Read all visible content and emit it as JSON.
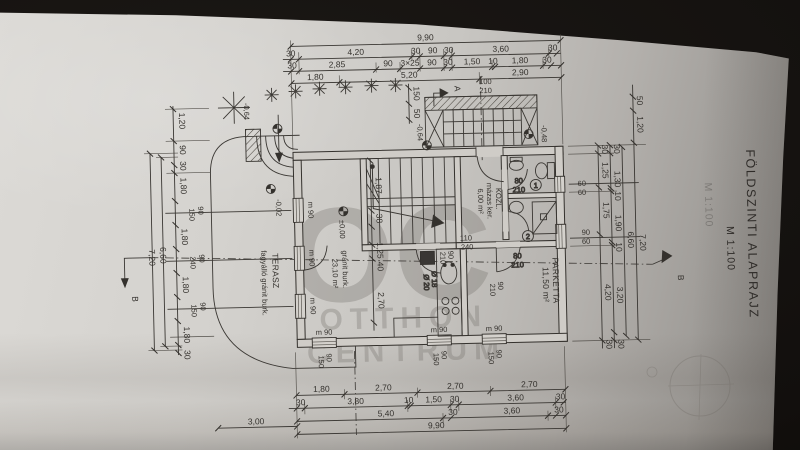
{
  "title_block": {
    "title": "FÖLDSZINTI ALAPRAJZ",
    "scale": "M 1:100",
    "ghost_scale": "M 1:100"
  },
  "watermark": {
    "big": "OC",
    "line2": "OTTHON",
    "line3": "CENTRUM"
  },
  "rooms": {
    "terasz": {
      "name": "TERASZ",
      "finish": "fagyálló gránit burk."
    },
    "living": {
      "finish": "gránit burk.",
      "area": "23,10 m²"
    },
    "kozl": {
      "name": "KÖZL.",
      "finish": "mázas ker.",
      "area": "6,00 m²"
    },
    "parketta": {
      "name": "PARKETTA",
      "area": "11,50 m²"
    }
  },
  "levels": {
    "terrace_steps": "-0,64",
    "terrace": "-0,02",
    "interior": "±0,00",
    "entry_left": "-0,64",
    "entry_right": "-0,48"
  },
  "sections": {
    "a": "A",
    "b": "B"
  },
  "doors": {
    "entrance": [
      "100",
      "210"
    ],
    "opening": [
      "110",
      "240"
    ],
    "kitchen": [
      "90",
      "210"
    ],
    "parketta": [
      "90",
      "210"
    ],
    "bath1": [
      "80",
      "210"
    ],
    "bath2": [
      "80",
      "210"
    ],
    "num1": "1",
    "num2": "2"
  },
  "chimney": [
    "Ø 18",
    "Ø 20"
  ],
  "windows": {
    "left": [
      {
        "m": "m 90",
        "w": "90",
        "h": "150"
      },
      {
        "m": "m 90",
        "w": "90",
        "h": "240"
      },
      {
        "m": "m 90",
        "w": "90",
        "h": "150"
      }
    ],
    "bottom": [
      {
        "m": "m 90",
        "w": "90",
        "h": "150"
      },
      {
        "m": "m 90",
        "w": "90",
        "h": "150"
      },
      {
        "m": "m 90",
        "w": "90",
        "h": "150"
      }
    ],
    "right": [
      [
        "60",
        "60"
      ],
      [
        "90",
        "60"
      ]
    ]
  },
  "dims": {
    "t1": "9,90",
    "t2": [
      "30",
      "4,20",
      "30",
      "90",
      "30",
      "3,60",
      "30"
    ],
    "t3": [
      "30",
      "2,85",
      "90",
      "3×25",
      "90",
      "30",
      "1,50",
      "10",
      "1,80",
      "30"
    ],
    "t4": [
      "1,80",
      "5,20",
      "2,90"
    ],
    "b1": [
      "1,80",
      "2,70",
      "2,70",
      "2,70"
    ],
    "b2": [
      "30",
      "3,80",
      "10",
      "1,50",
      "30",
      "3,60",
      "30"
    ],
    "b3": [
      "5,40",
      "30",
      "3,60",
      "30"
    ],
    "b4": "9,90",
    "b5": "3,00",
    "l1": [
      "1,20",
      "90",
      "30",
      "1,80",
      "1,80",
      "1,80",
      "1,80",
      "30"
    ],
    "l2": "6,60",
    "l3": "7,20",
    "r1": [
      "30",
      "1,25",
      "1,75",
      "4,20",
      "30"
    ],
    "r2": [
      "30",
      "1,30",
      "10",
      "1,90",
      "10",
      "3,20",
      "30"
    ],
    "r3": "6,60",
    "r4": "7,20",
    "rt": [
      "50",
      "1,20"
    ],
    "steps": [
      "150",
      "50"
    ],
    "interior": [
      "1,87",
      "38",
      "1,25",
      "40",
      "2,70"
    ]
  }
}
